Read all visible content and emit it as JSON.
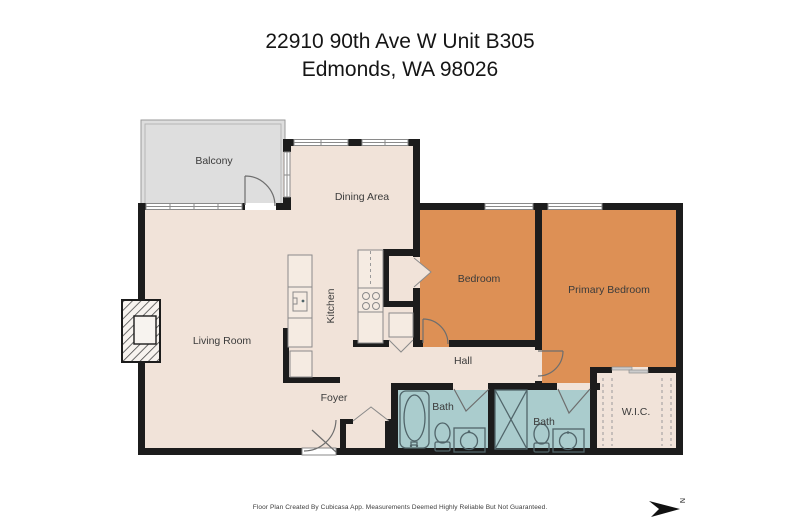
{
  "title": {
    "line1": "22910 90th Ave W Unit B305",
    "line2": "Edmonds, WA 98026"
  },
  "rooms": {
    "balcony": "Balcony",
    "dining": "Dining Area",
    "living": "Living Room",
    "kitchen": "Kitchen",
    "foyer": "Foyer",
    "hall": "Hall",
    "bedroom": "Bedroom",
    "primary": "Primary Bedroom",
    "bath1": "Bath",
    "bath2": "Bath",
    "wic": "W.I.C."
  },
  "footer": {
    "disclaimer": "Floor Plan Created By Cubicasa App. Measurements Deemed Highly Reliable But Not Guaranteed."
  },
  "compass": {
    "letter": "N"
  },
  "colors": {
    "floor_beige": "#f1e3d9",
    "bedroom_orange": "#dd9055",
    "bath_teal": "#aacccd",
    "balcony_gray": "#dedede",
    "wall_black": "#1c1c1c",
    "fixture_line": "#51656a",
    "text_dark": "#3b3b3b"
  }
}
